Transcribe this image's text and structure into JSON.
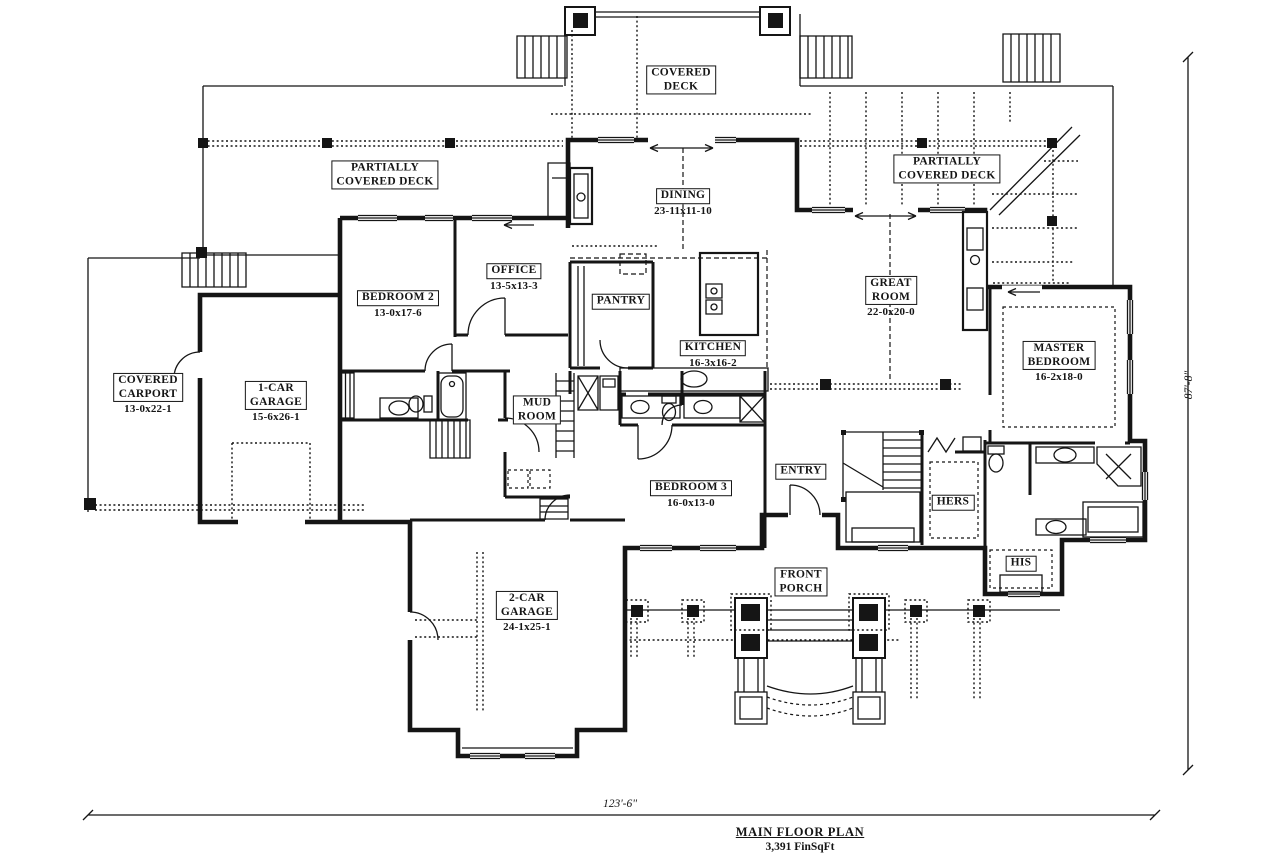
{
  "drawing": {
    "title": "MAIN FLOOR PLAN",
    "area": "3,391 FinSqFt",
    "width_dim": "123'-6\"",
    "height_dim": "87'-8\""
  },
  "rooms": {
    "covered_deck": {
      "name": "COVERED\nDECK",
      "dims": ""
    },
    "pcd_left": {
      "name": "PARTIALLY\nCOVERED DECK",
      "dims": ""
    },
    "pcd_right": {
      "name": "PARTIALLY\nCOVERED DECK",
      "dims": ""
    },
    "dining": {
      "name": "DINING",
      "dims": "23-11x11-10"
    },
    "office": {
      "name": "OFFICE",
      "dims": "13-5x13-3"
    },
    "bedroom2": {
      "name": "BEDROOM 2",
      "dims": "13-0x17-6"
    },
    "pantry": {
      "name": "PANTRY",
      "dims": ""
    },
    "kitchen": {
      "name": "KITCHEN",
      "dims": "16-3x16-2"
    },
    "great_room": {
      "name": "GREAT\nROOM",
      "dims": "22-0x20-0"
    },
    "master_bedroom": {
      "name": "MASTER\nBEDROOM",
      "dims": "16-2x18-0"
    },
    "covered_carport": {
      "name": "COVERED\nCARPORT",
      "dims": "13-0x22-1"
    },
    "one_car_garage": {
      "name": "1-CAR\nGARAGE",
      "dims": "15-6x26-1"
    },
    "mud_room": {
      "name": "MUD\nROOM",
      "dims": ""
    },
    "bedroom3": {
      "name": "BEDROOM 3",
      "dims": "16-0x13-0"
    },
    "entry": {
      "name": "ENTRY",
      "dims": ""
    },
    "hers": {
      "name": "HERS",
      "dims": ""
    },
    "his": {
      "name": "HIS",
      "dims": ""
    },
    "two_car_garage": {
      "name": "2-CAR\nGARAGE",
      "dims": "24-1x25-1"
    },
    "front_porch": {
      "name": "FRONT\nPORCH",
      "dims": ""
    }
  },
  "colors": {
    "ink": "#151515",
    "paper": "#ffffff"
  }
}
